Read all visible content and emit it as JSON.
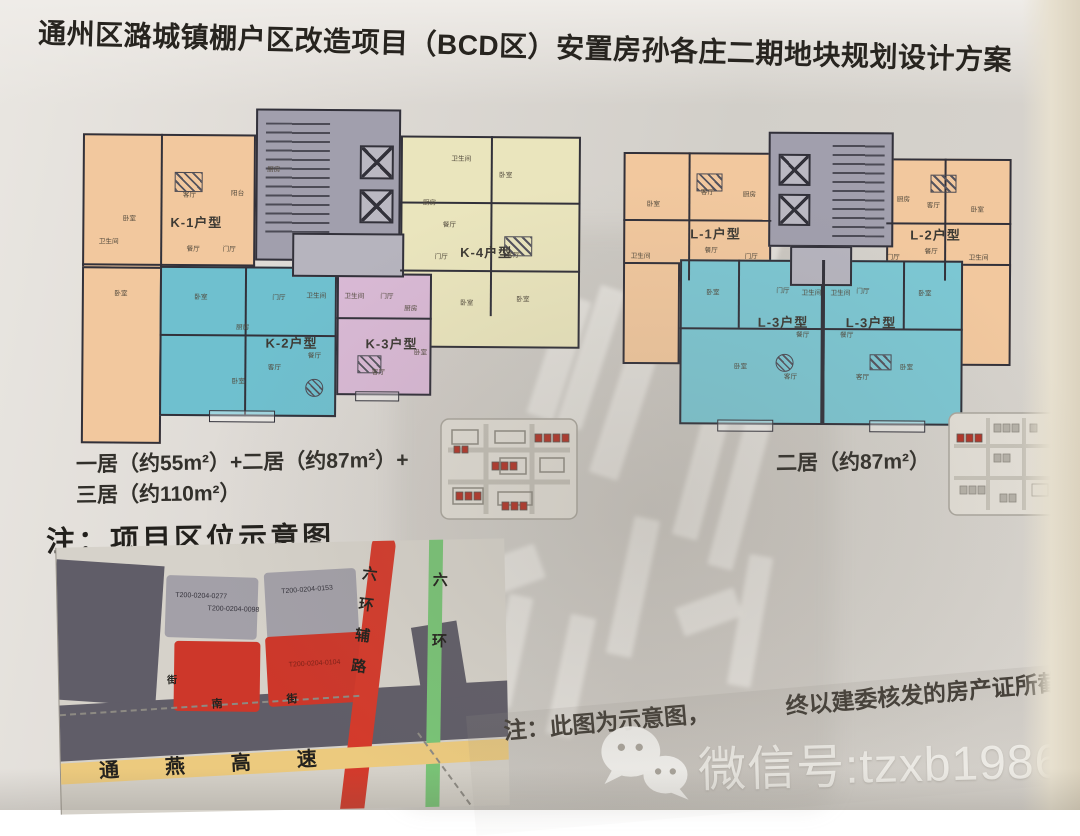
{
  "title": "通州区潞城镇棚户区改造项目（BCD区）安置房孙各庄二期地块规划设计方案",
  "plans": {
    "left": {
      "units": [
        {
          "code": "K-1",
          "label": "K-1户型",
          "color": "#f2c89e"
        },
        {
          "code": "K-2",
          "label": "K-2户型",
          "color": "#6fc0cf"
        },
        {
          "code": "K-3",
          "label": "K-3户型",
          "color": "#d9b9d5"
        },
        {
          "code": "K-4",
          "label": "K-4户型",
          "color": "#eae5bd"
        }
      ],
      "core_color": "#a19fad",
      "rooms": [
        {
          "t": "卧室",
          "x": 52,
          "y": 110
        },
        {
          "t": "客厅",
          "x": 112,
          "y": 86
        },
        {
          "t": "阳台",
          "x": 160,
          "y": 84
        },
        {
          "t": "餐厅",
          "x": 116,
          "y": 140
        },
        {
          "t": "门厅",
          "x": 152,
          "y": 140
        },
        {
          "t": "卫生间",
          "x": 28,
          "y": 133
        },
        {
          "t": "卧室",
          "x": 44,
          "y": 185
        },
        {
          "t": "厨房",
          "x": 196,
          "y": 60
        },
        {
          "t": "卧室",
          "x": 124,
          "y": 188
        },
        {
          "t": "厨房",
          "x": 166,
          "y": 218
        },
        {
          "t": "门厅",
          "x": 202,
          "y": 188
        },
        {
          "t": "卫生间",
          "x": 236,
          "y": 186
        },
        {
          "t": "客厅",
          "x": 198,
          "y": 258
        },
        {
          "t": "餐厅",
          "x": 238,
          "y": 246
        },
        {
          "t": "卧室",
          "x": 162,
          "y": 272
        },
        {
          "t": "卫生间",
          "x": 274,
          "y": 186
        },
        {
          "t": "门厅",
          "x": 310,
          "y": 186
        },
        {
          "t": "厨房",
          "x": 334,
          "y": 198
        },
        {
          "t": "客厅",
          "x": 302,
          "y": 262
        },
        {
          "t": "卧室",
          "x": 344,
          "y": 242
        },
        {
          "t": "卫生间",
          "x": 380,
          "y": 48
        },
        {
          "t": "卧室",
          "x": 428,
          "y": 64
        },
        {
          "t": "厨房",
          "x": 352,
          "y": 92
        },
        {
          "t": "餐厅",
          "x": 372,
          "y": 114
        },
        {
          "t": "客厅",
          "x": 436,
          "y": 144
        },
        {
          "t": "门厅",
          "x": 364,
          "y": 146
        },
        {
          "t": "卧室",
          "x": 390,
          "y": 192
        },
        {
          "t": "卧室",
          "x": 446,
          "y": 188
        }
      ],
      "summary_line1": "一居（约55m²）+二居（约87m²）+",
      "summary_line2": "三居（约110m²）"
    },
    "right": {
      "units": [
        {
          "code": "L-1",
          "label": "L-1户型",
          "color": "#f2c89e"
        },
        {
          "code": "L-2",
          "label": "L-2户型",
          "color": "#f2c89e"
        },
        {
          "code": "L-3",
          "label": "L-3户型",
          "color": "#7cc7d3"
        }
      ],
      "core_color": "#a19fad",
      "rooms": [
        {
          "t": "卧室",
          "x": 28,
          "y": 72
        },
        {
          "t": "客厅",
          "x": 82,
          "y": 60
        },
        {
          "t": "厨房",
          "x": 124,
          "y": 62
        },
        {
          "t": "餐厅",
          "x": 86,
          "y": 118
        },
        {
          "t": "门厅",
          "x": 126,
          "y": 124
        },
        {
          "t": "卫生间",
          "x": 12,
          "y": 124
        },
        {
          "t": "客厅",
          "x": 308,
          "y": 72
        },
        {
          "t": "卧室",
          "x": 352,
          "y": 76
        },
        {
          "t": "厨房",
          "x": 278,
          "y": 66
        },
        {
          "t": "餐厅",
          "x": 306,
          "y": 118
        },
        {
          "t": "门厅",
          "x": 268,
          "y": 124
        },
        {
          "t": "卫生间",
          "x": 350,
          "y": 124
        },
        {
          "t": "卧室",
          "x": 88,
          "y": 160
        },
        {
          "t": "门厅",
          "x": 158,
          "y": 158
        },
        {
          "t": "卫生间",
          "x": 183,
          "y": 160
        },
        {
          "t": "餐厅",
          "x": 178,
          "y": 202
        },
        {
          "t": "客厅",
          "x": 166,
          "y": 244
        },
        {
          "t": "卧室",
          "x": 116,
          "y": 234
        },
        {
          "t": "卫生间",
          "x": 212,
          "y": 160
        },
        {
          "t": "门厅",
          "x": 238,
          "y": 158
        },
        {
          "t": "卧室",
          "x": 300,
          "y": 160
        },
        {
          "t": "餐厅",
          "x": 222,
          "y": 202
        },
        {
          "t": "客厅",
          "x": 238,
          "y": 244
        },
        {
          "t": "卧室",
          "x": 282,
          "y": 234
        }
      ],
      "summary": "二居（约87m²）"
    }
  },
  "map": {
    "heading": "注：项目区位示意图",
    "parcel_labels": [
      "T200-0204-0277",
      "T200-0204-0098",
      "T200-0204-0153",
      "T200-0204-0104"
    ],
    "roads": {
      "expressway": "通燕高速",
      "ring_aux": "六环辅路",
      "ring": "六环",
      "street": "南街",
      "street_vertical": "街"
    },
    "colors": {
      "parcel_dark": "#605d68",
      "parcel_light": "#a3a0a8",
      "parcel_red": "#cd372a",
      "road_red": "#d43a2b",
      "road_green": "#79c476",
      "road_yellow": "#ecca7e"
    }
  },
  "footer": {
    "note_prefix": "注：此图为示意图，",
    "note_suffix": "终以建委核发的房产证所截面积为准",
    "watermark": "微信号:tzxb1986"
  }
}
